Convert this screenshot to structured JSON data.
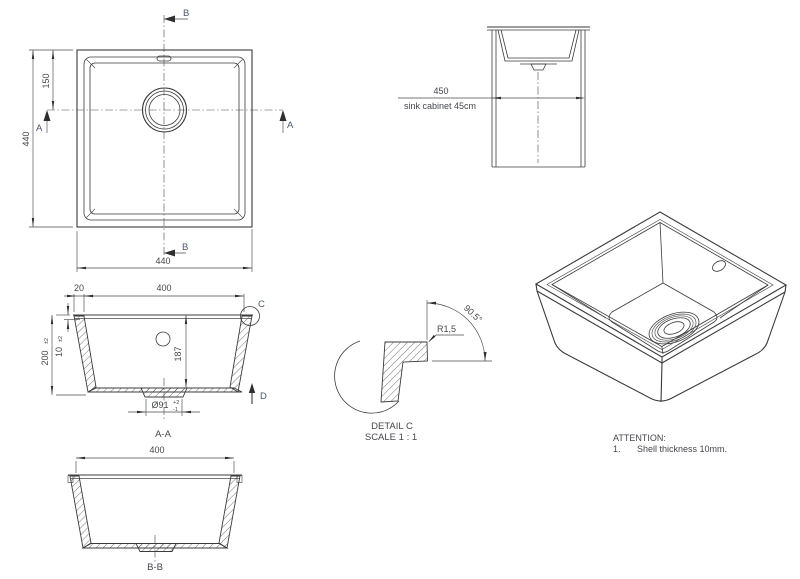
{
  "colors": {
    "line": "#3b3b3b",
    "text": "#45474d"
  },
  "plan": {
    "section_b_top": "B",
    "section_b_bottom": "B",
    "section_a_left": "A",
    "section_a_right": "A",
    "dim_height": "440",
    "dim_drain_offset": "150",
    "dim_width": "440"
  },
  "cabinet": {
    "dim_width": "450",
    "caption": "sink cabinet 45cm"
  },
  "section_aa": {
    "dim_rim": "20",
    "dim_opening": "400",
    "dim_shell": "10",
    "dim_shell_tol": "±2",
    "dim_height": "200",
    "dim_height_tol": "±2",
    "dim_depth": "187",
    "dim_drain": "Ø91",
    "dim_drain_tol_plus": "+2",
    "dim_drain_tol_minus": "-1",
    "detail_marker": "C",
    "direction_marker": "D",
    "title": "A-A"
  },
  "section_bb": {
    "dim_opening": "400",
    "title": "B-B"
  },
  "detail_c": {
    "dim_radius": "R1,5",
    "dim_angle": "90.5°",
    "title": "DETAIL C",
    "scale": "SCALE 1 : 1"
  },
  "notes": {
    "heading": "ATTENTION:",
    "item_number": "1.",
    "item_text": "Shell thickness 10mm."
  }
}
